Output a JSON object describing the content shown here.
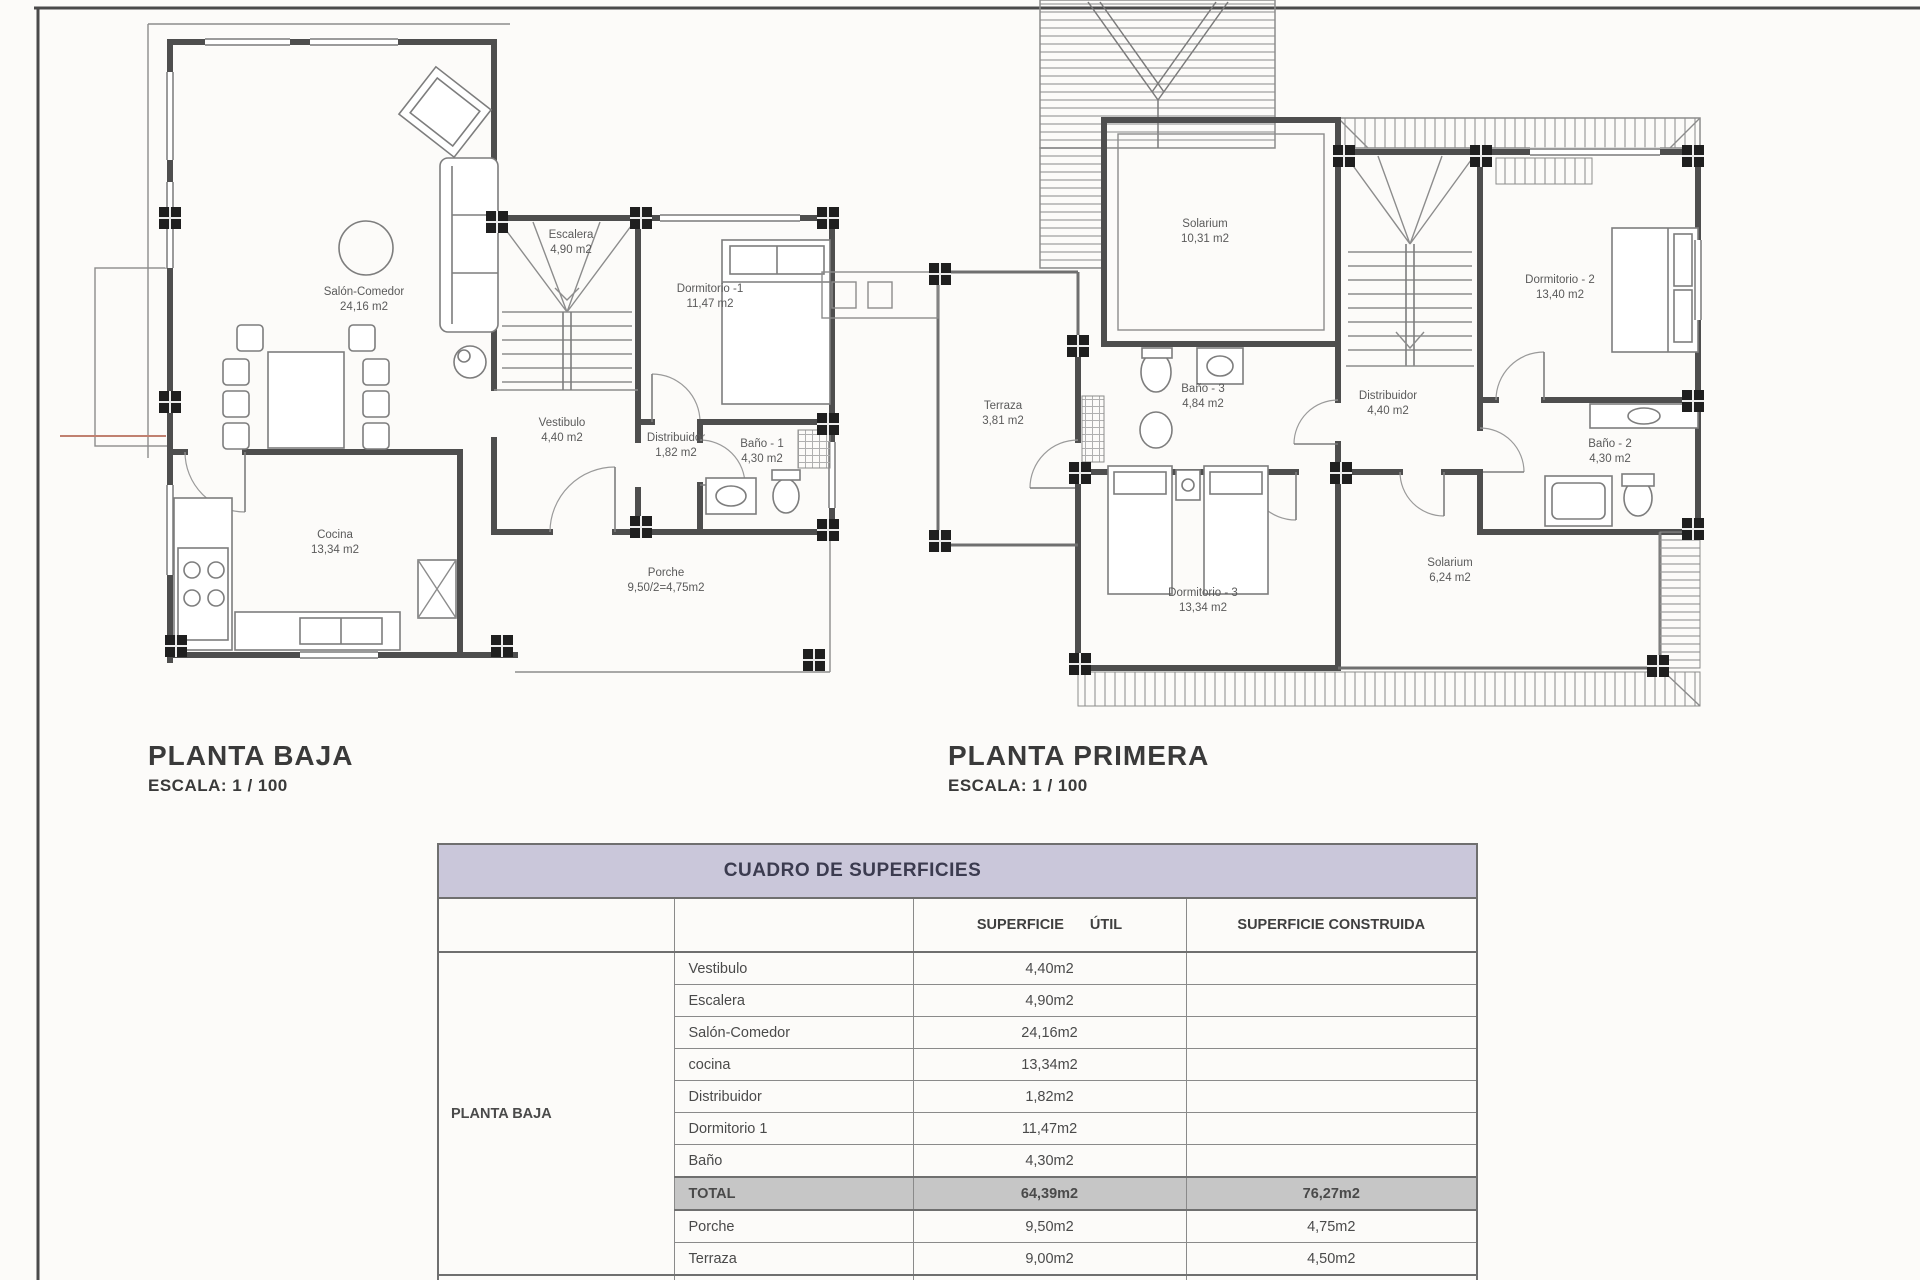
{
  "plans": {
    "ground": {
      "title": "PLANTA BAJA",
      "scale": "ESCALA: 1 / 100",
      "rooms": [
        {
          "name": "Salón-Comedor",
          "area": "24,16 m2",
          "x": 364,
          "y": 300
        },
        {
          "name": "Escalera",
          "area": "4,90 m2",
          "x": 571,
          "y": 243
        },
        {
          "name": "Dormitorio -1",
          "area": "11,47 m2",
          "x": 710,
          "y": 297
        },
        {
          "name": "Vestibulo",
          "area": "4,40 m2",
          "x": 562,
          "y": 431
        },
        {
          "name": "Distribuidor",
          "area": "1,82 m2",
          "x": 676,
          "y": 446
        },
        {
          "name": "Baño - 1",
          "area": "4,30 m2",
          "x": 762,
          "y": 452
        },
        {
          "name": "Cocina",
          "area": "13,34 m2",
          "x": 335,
          "y": 543
        },
        {
          "name": "Porche",
          "area": "9,50/2=4,75m2",
          "x": 666,
          "y": 581
        }
      ]
    },
    "first": {
      "title": "PLANTA PRIMERA",
      "scale": "ESCALA: 1 / 100",
      "rooms": [
        {
          "name": "Solarium",
          "area": "10,31 m2",
          "x": 1205,
          "y": 232
        },
        {
          "name": "Terraza",
          "area": "3,81 m2",
          "x": 1003,
          "y": 414
        },
        {
          "name": "Baño - 3",
          "area": "4,84 m2",
          "x": 1203,
          "y": 397
        },
        {
          "name": "Distribuidor",
          "area": "4,40 m2",
          "x": 1388,
          "y": 404
        },
        {
          "name": "Dormitorio - 2",
          "area": "13,40 m2",
          "x": 1560,
          "y": 288
        },
        {
          "name": "Baño - 2",
          "area": "4,30 m2",
          "x": 1610,
          "y": 452
        },
        {
          "name": "Dormitorio - 3",
          "area": "13,34 m2",
          "x": 1203,
          "y": 601
        },
        {
          "name": "Solarium",
          "area": "6,24 m2",
          "x": 1450,
          "y": 571
        }
      ]
    }
  },
  "table": {
    "title": "CUADRO DE SUPERFICIES",
    "col_util": "SUPERFICIE ÚTIL",
    "col_construida": "SUPERFICIE CONSTRUIDA",
    "group_label": "PLANTA BAJA",
    "rows": [
      {
        "room": "Vestibulo",
        "util": "4,40m2",
        "cons": "",
        "total": false
      },
      {
        "room": "Escalera",
        "util": "4,90m2",
        "cons": "",
        "total": false
      },
      {
        "room": "Salón-Comedor",
        "util": "24,16m2",
        "cons": "",
        "total": false
      },
      {
        "room": "cocina",
        "util": "13,34m2",
        "cons": "",
        "total": false
      },
      {
        "room": "Distribuidor",
        "util": "1,82m2",
        "cons": "",
        "total": false
      },
      {
        "room": "Dormitorio 1",
        "util": "11,47m2",
        "cons": "",
        "total": false
      },
      {
        "room": "Baño",
        "util": "4,30m2",
        "cons": "",
        "total": false
      },
      {
        "room": "TOTAL",
        "util": "64,39m2",
        "cons": "76,27m2",
        "total": true
      },
      {
        "room": "Porche",
        "util": "9,50m2",
        "cons": "4,75m2",
        "total": false
      },
      {
        "room": "Terraza",
        "util": "9,00m2",
        "cons": "4,50m2",
        "total": false
      }
    ]
  },
  "colors": {
    "table_title_bg": "#cac7da",
    "total_row_bg": "#c6c6c6",
    "ink": "#4e4e4e",
    "paper": "#fcfbf9"
  }
}
